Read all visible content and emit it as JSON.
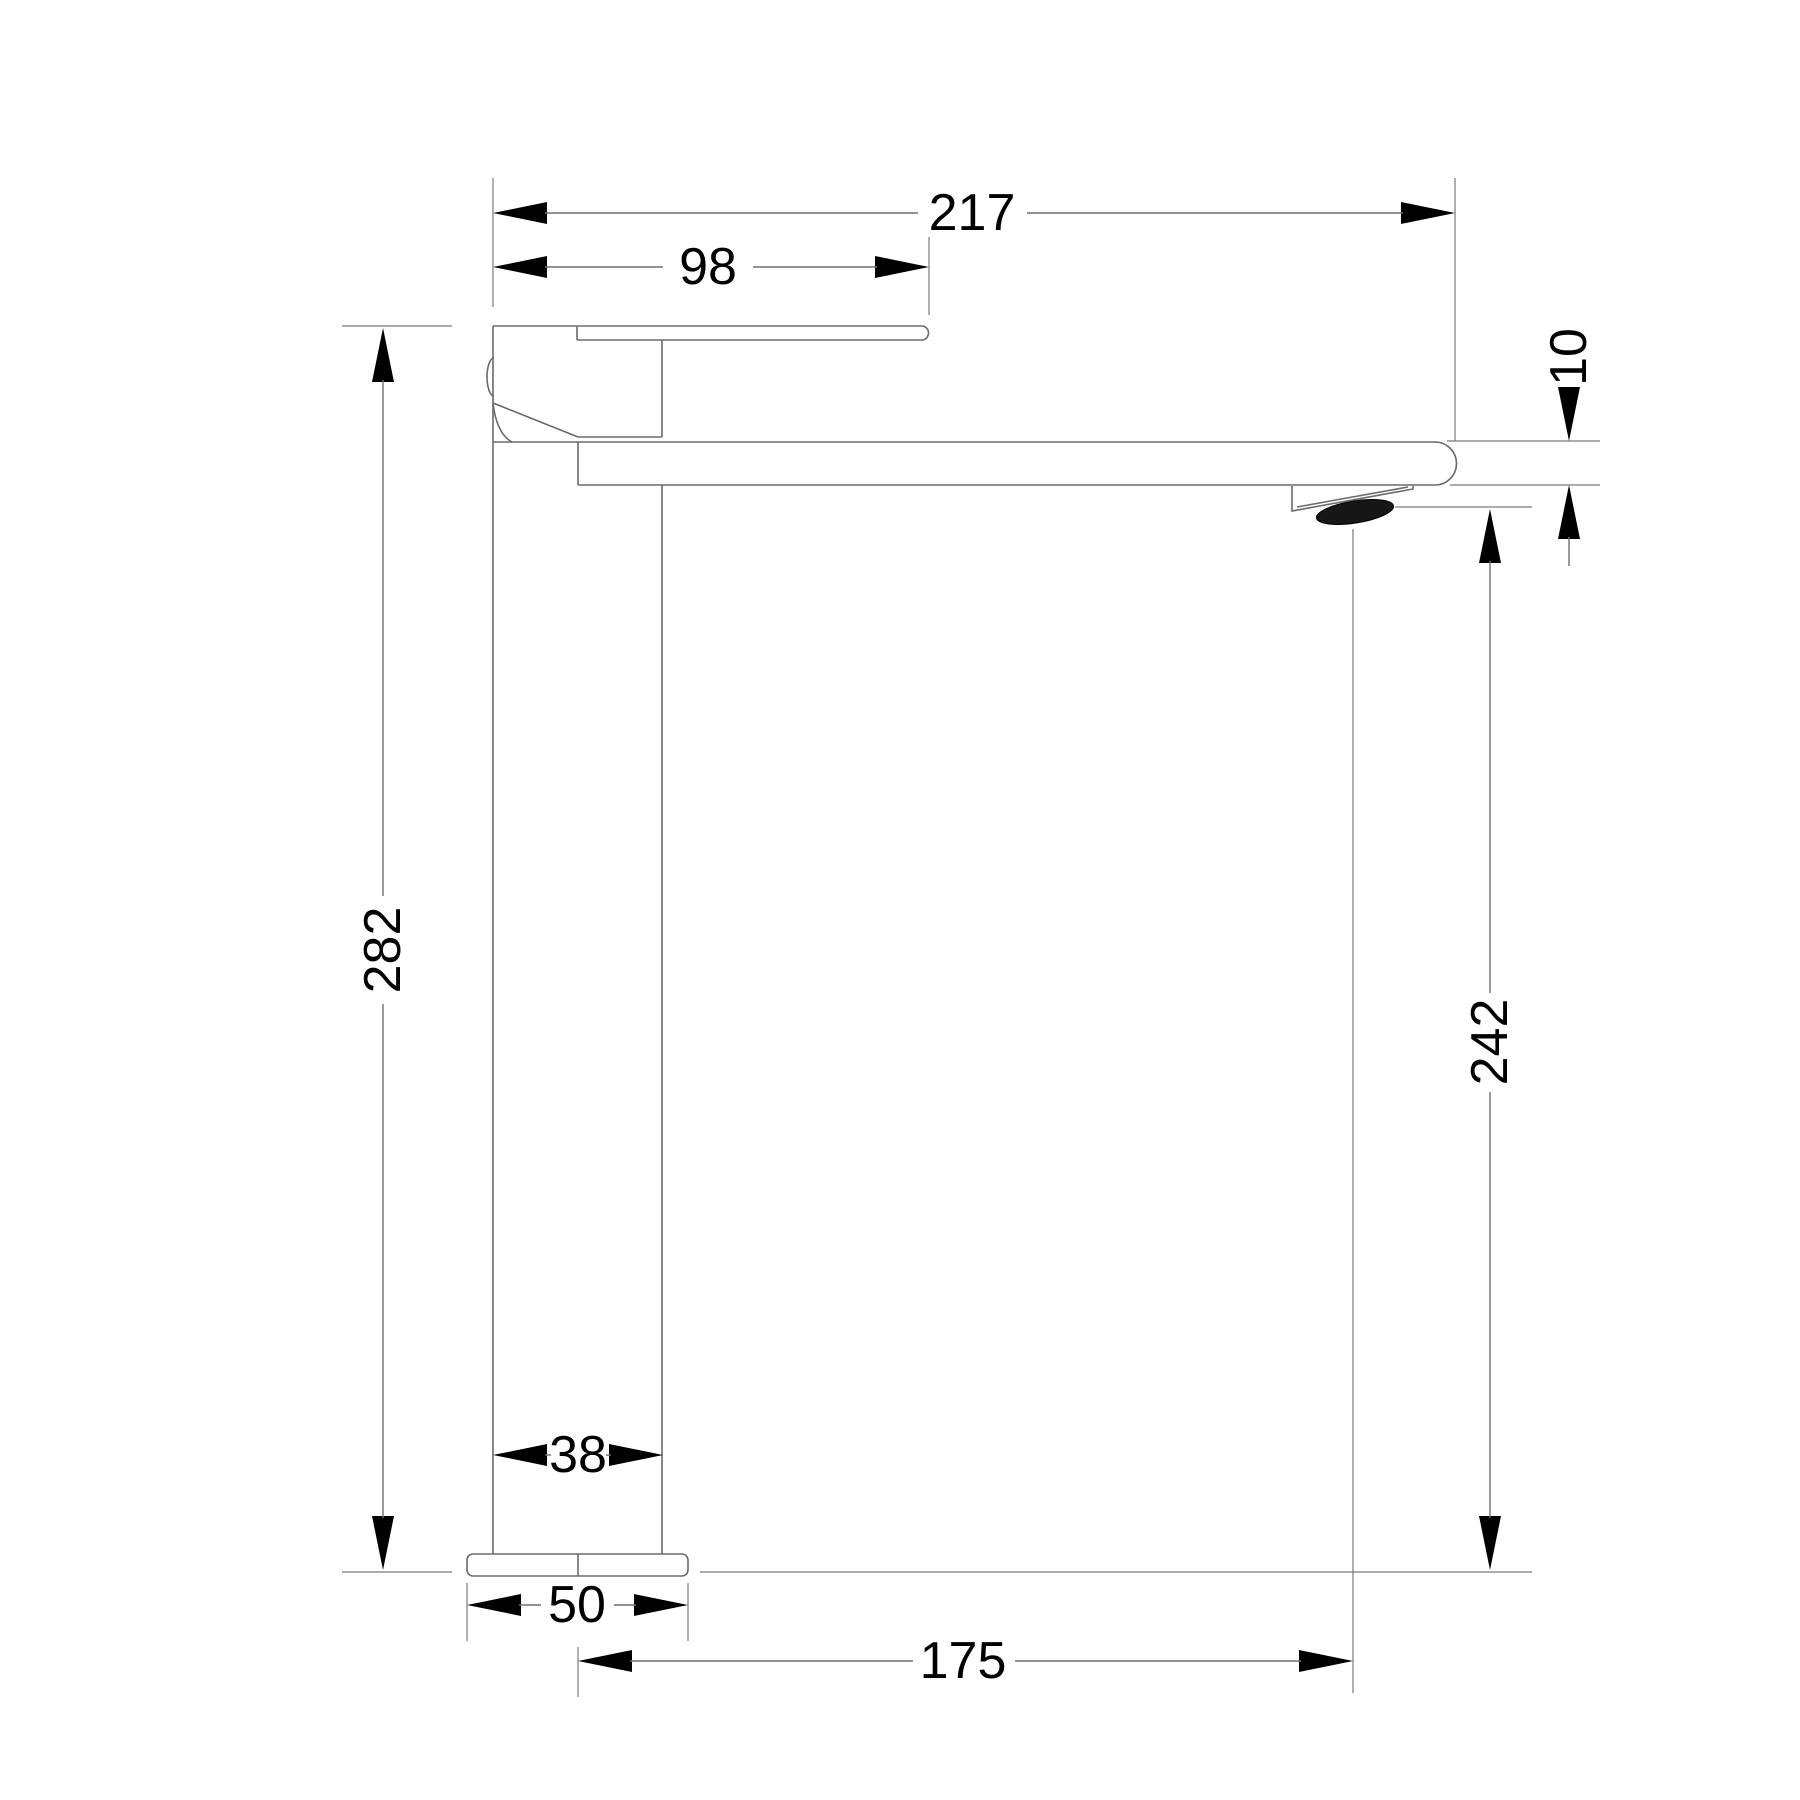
{
  "drawing": {
    "type": "technical-dimension-drawing",
    "subject": "tall single-lever basin mixer tap, side elevation",
    "background_color": "#ffffff",
    "outline_color": "#6b6b6b",
    "dimension_color": "#000000",
    "units": "mm",
    "dimensions": {
      "overall_width": "217",
      "handle_length": "98",
      "spout_thickness": "10",
      "overall_height": "282",
      "spout_outlet_height": "242",
      "body_width": "38",
      "base_width": "50",
      "spout_reach": "175"
    }
  }
}
